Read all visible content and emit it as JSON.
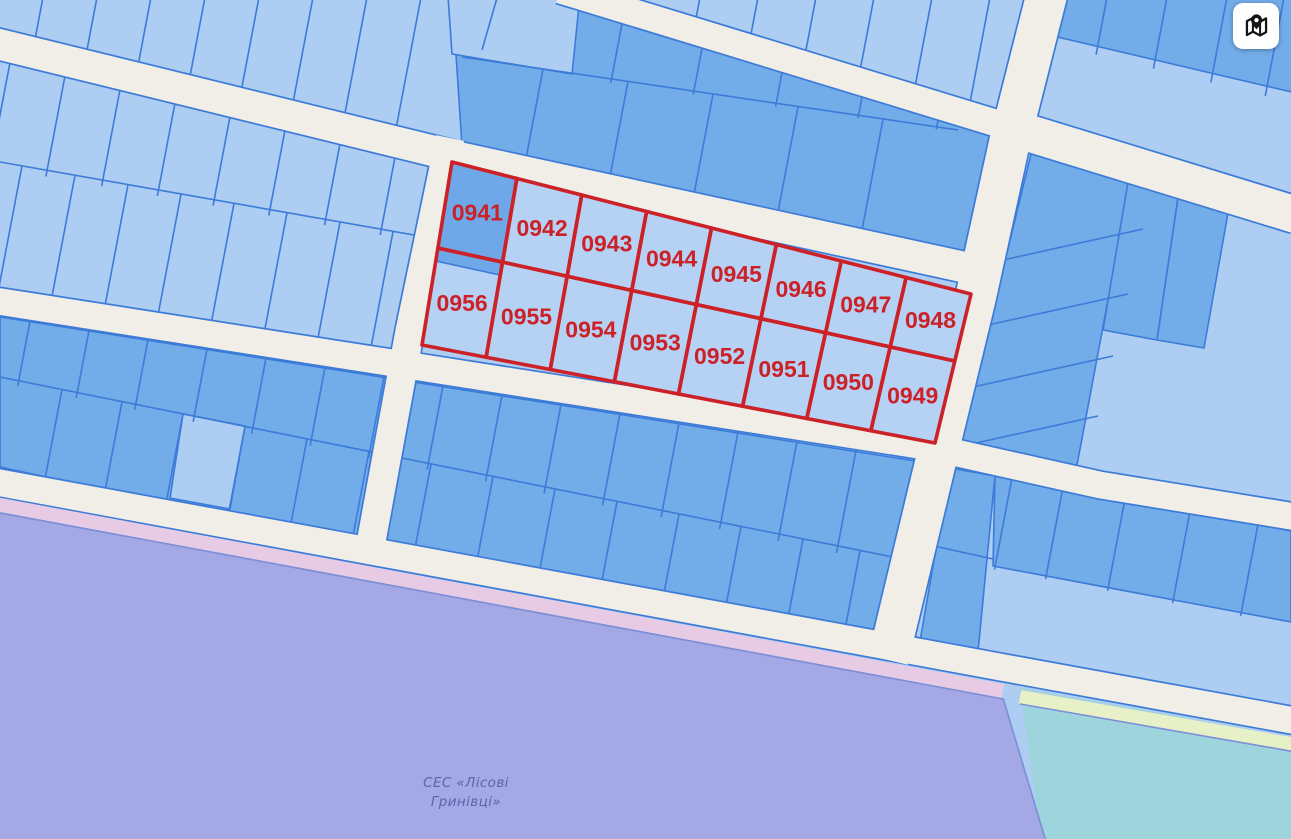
{
  "map": {
    "region_label_lines": [
      "СЕС «Лісові",
      "Гринівці»"
    ],
    "highlighted_block": {
      "top_row_numbers": [
        "0941",
        "0942",
        "0943",
        "0944",
        "0945",
        "0946",
        "0947",
        "0948"
      ],
      "bottom_row_numbers": [
        "0956",
        "0955",
        "0954",
        "0953",
        "0952",
        "0951",
        "0950",
        "0949"
      ]
    },
    "colors": {
      "road": "#f0eee6",
      "parcel_light": "#aecdf3",
      "parcel_medium": "#72ace9",
      "parcel_dark": "#6fa8e8",
      "parcel_border": "#3c7bd8",
      "highlight_red": "#cc2127",
      "highlight_fill": "#b5d1f4",
      "zone_purple": "#a4a8e4",
      "zone_pink": "#e7cbe4",
      "zone_cyan": "#9ed4db",
      "zone_yellow": "#e8f0c8",
      "zone_line": "#7b8fd8",
      "label_purple": "#5f63ae"
    },
    "controls": {
      "map_button_icon": "map-with-pin-icon"
    }
  }
}
